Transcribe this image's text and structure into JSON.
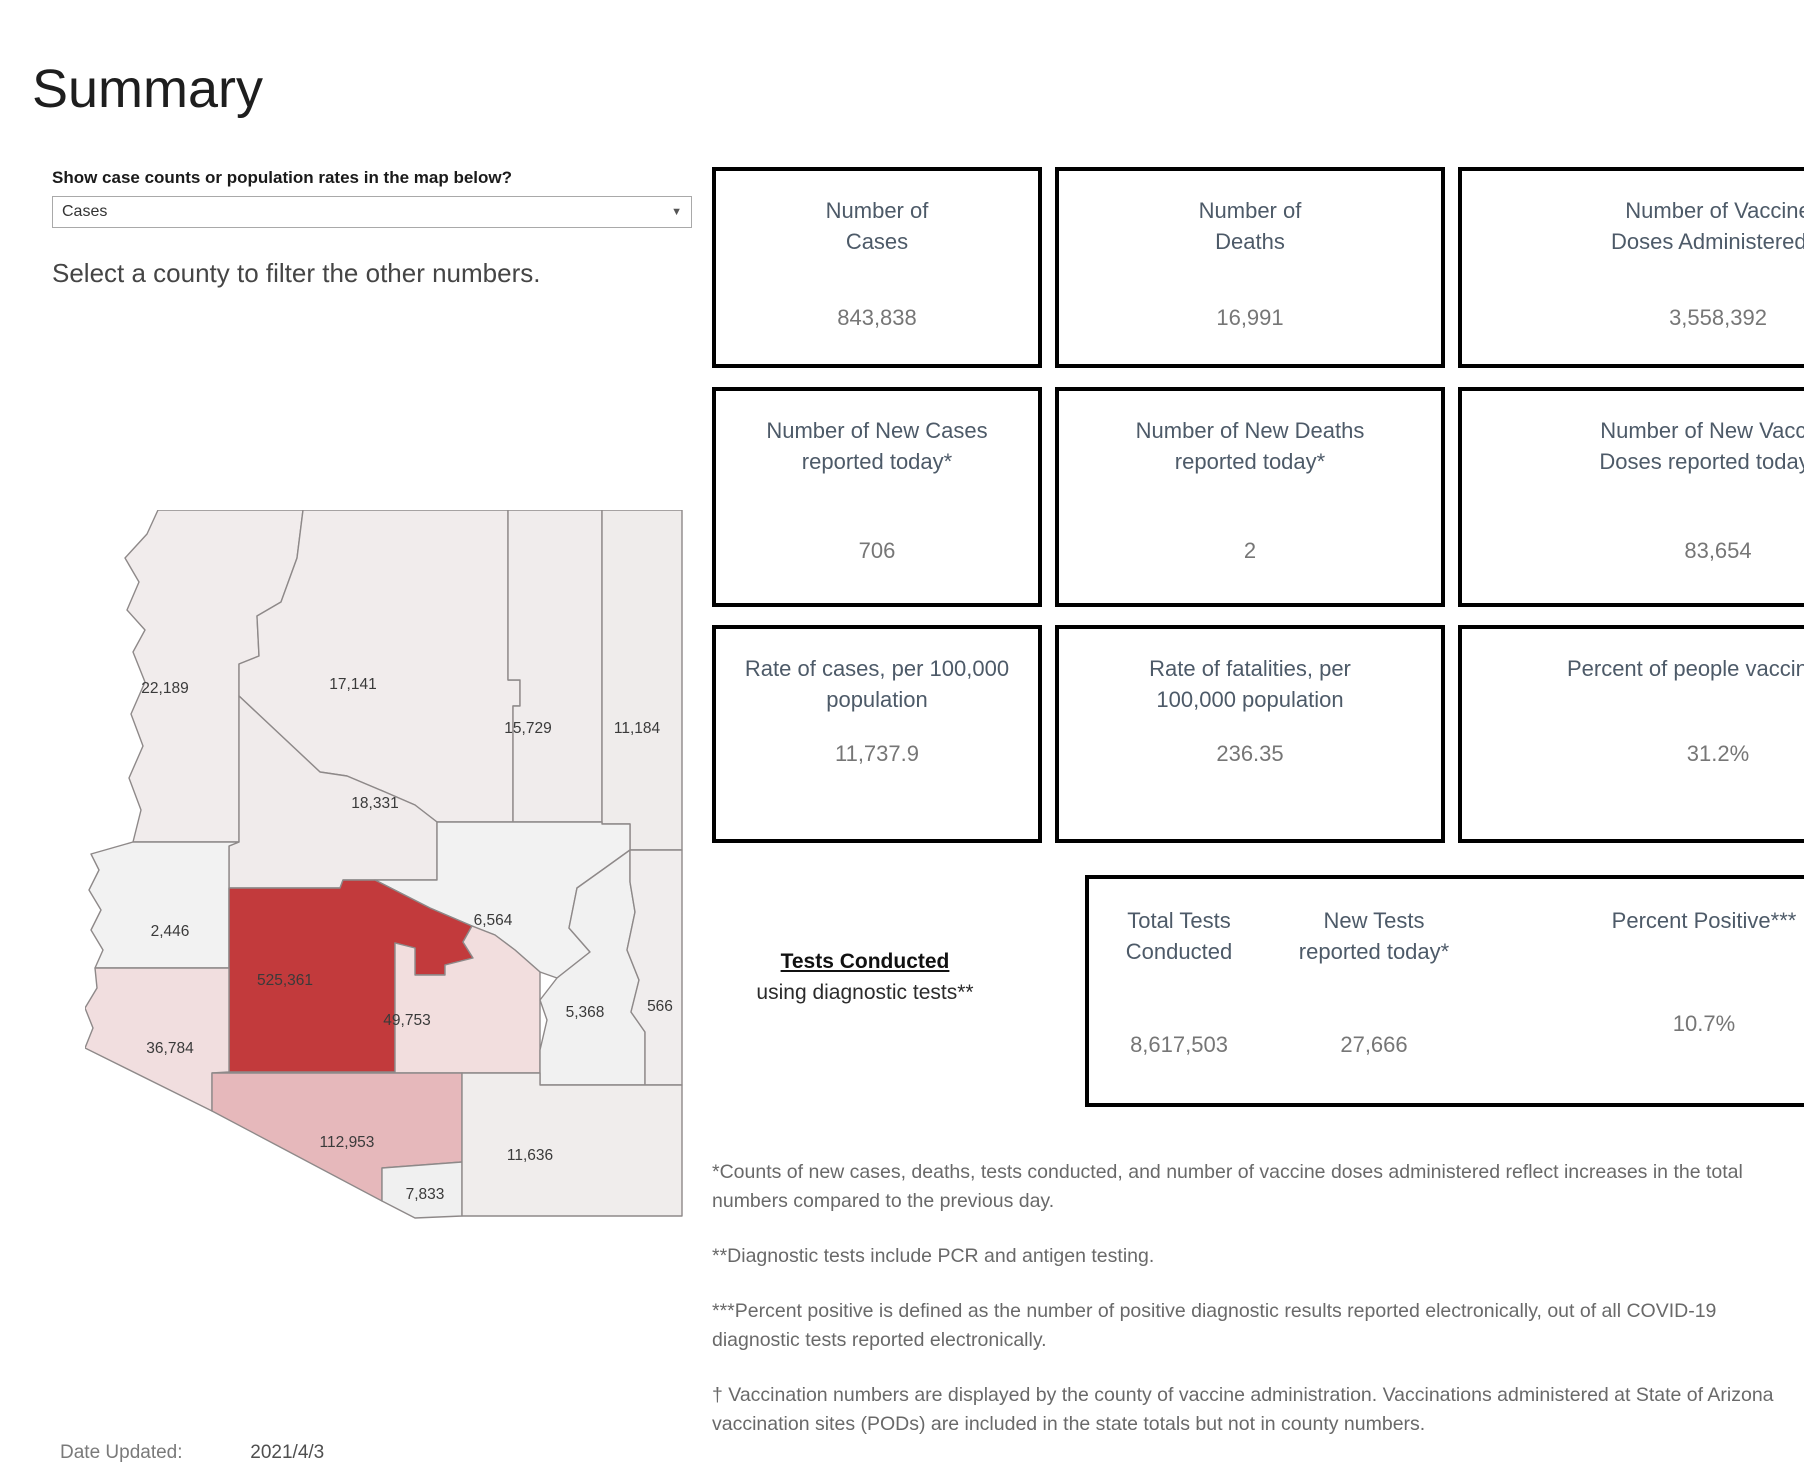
{
  "title": "Summary",
  "map_filter": {
    "label": "Show case counts or population rates in the map below?",
    "value": "Cases"
  },
  "map_hint": "Select a county to filter the other numbers.",
  "map": {
    "counties": [
      {
        "name": "Mohave",
        "value": "22,189",
        "color": "#f1ecec"
      },
      {
        "name": "Coconino",
        "value": "17,141",
        "color": "#f1ecec"
      },
      {
        "name": "Navajo",
        "value": "15,729",
        "color": "#f0ecec"
      },
      {
        "name": "Apache",
        "value": "11,184",
        "color": "#efeceb"
      },
      {
        "name": "Yavapai",
        "value": "18,331",
        "color": "#f0ebeb"
      },
      {
        "name": "La Paz",
        "value": "2,446",
        "color": "#f2f2f2"
      },
      {
        "name": "Maricopa",
        "value": "525,361",
        "color": "#c23a3c"
      },
      {
        "name": "Gila",
        "value": "6,564",
        "color": "#f2f2f2"
      },
      {
        "name": "Yuma",
        "value": "36,784",
        "color": "#f1dedf"
      },
      {
        "name": "Pinal",
        "value": "49,753",
        "color": "#f2dede"
      },
      {
        "name": "Graham",
        "value": "5,368",
        "color": "#f1f1f1"
      },
      {
        "name": "Greenlee",
        "value": "566",
        "color": "#f0eded"
      },
      {
        "name": "Pima",
        "value": "112,953",
        "color": "#e6b8bb"
      },
      {
        "name": "Santa Cruz",
        "value": "7,833",
        "color": "#f0f0f0"
      },
      {
        "name": "Cochise",
        "value": "11,636",
        "color": "#f0edec"
      }
    ]
  },
  "stat_boxes": [
    {
      "line1": "Number of",
      "line2": "Cases",
      "value": "843,838"
    },
    {
      "line1": "Number of",
      "line2": "Deaths",
      "value": "16,991"
    },
    {
      "line1": "Number of Vaccine",
      "line2": "Doses Administered †",
      "value": "3,558,392"
    },
    {
      "line1": "Number of New Cases",
      "line2": "reported today*",
      "value": "706"
    },
    {
      "line1": "Number of New Deaths",
      "line2": "reported today*",
      "value": "2"
    },
    {
      "line1": "Number of New Vaccine",
      "line2": "Doses reported today* †",
      "value": "83,654"
    },
    {
      "line1": "Rate of cases, per 100,000",
      "line2": "population",
      "value": "11,737.9"
    },
    {
      "line1": "Rate of fatalities, per",
      "line2": "100,000 population",
      "value": "236.35"
    },
    {
      "line1": "Percent of people vaccinated †",
      "line2": "",
      "value": "31.2%"
    }
  ],
  "tests_panel": {
    "heading": "Tests Conducted",
    "subheading": "using diagnostic tests**",
    "columns": [
      {
        "line1": "Total Tests",
        "line2": "Conducted",
        "value": "8,617,503"
      },
      {
        "line1": "New Tests",
        "line2": "reported today*",
        "value": "27,666"
      },
      {
        "line1": "Percent Positive***",
        "line2": "",
        "value": "10.7%"
      }
    ]
  },
  "footnotes": [
    "*Counts of new cases, deaths, tests conducted, and number of vaccine doses administered reflect increases in the total numbers compared to the previous day.",
    "**Diagnostic tests include PCR and antigen testing.",
    "***Percent positive is defined as the number of positive diagnostic results reported electronically, out of all COVID-19 diagnostic tests reported electronically.",
    "† Vaccination numbers are displayed by the county of vaccine administration. Vaccinations administered at State of Arizona vaccination sites (PODs) are included in the state totals but not in county numbers."
  ],
  "date_updated": {
    "label": "Date Updated:",
    "value": "2021/4/3"
  },
  "chart_data": {
    "type": "heatmap",
    "metric": "Cases",
    "regions": [
      {
        "name": "Mohave",
        "value": 22189
      },
      {
        "name": "Coconino",
        "value": 17141
      },
      {
        "name": "Navajo",
        "value": 15729
      },
      {
        "name": "Apache",
        "value": 11184
      },
      {
        "name": "Yavapai",
        "value": 18331
      },
      {
        "name": "La Paz",
        "value": 2446
      },
      {
        "name": "Maricopa",
        "value": 525361
      },
      {
        "name": "Gila",
        "value": 6564
      },
      {
        "name": "Yuma",
        "value": 36784
      },
      {
        "name": "Pinal",
        "value": 49753
      },
      {
        "name": "Graham",
        "value": 5368
      },
      {
        "name": "Greenlee",
        "value": 566
      },
      {
        "name": "Pima",
        "value": 112953
      },
      {
        "name": "Santa Cruz",
        "value": 7833
      },
      {
        "name": "Cochise",
        "value": 11636
      }
    ],
    "summary": {
      "number_of_cases": 843838,
      "number_of_deaths": 16991,
      "vaccine_doses_administered": 3558392,
      "new_cases_today": 706,
      "new_deaths_today": 2,
      "new_vaccine_doses_today": 83654,
      "case_rate_per_100k": 11737.9,
      "fatality_rate_per_100k": 236.35,
      "percent_vaccinated": 31.2,
      "total_tests_conducted": 8617503,
      "new_tests_today": 27666,
      "percent_positive": 10.7
    }
  }
}
